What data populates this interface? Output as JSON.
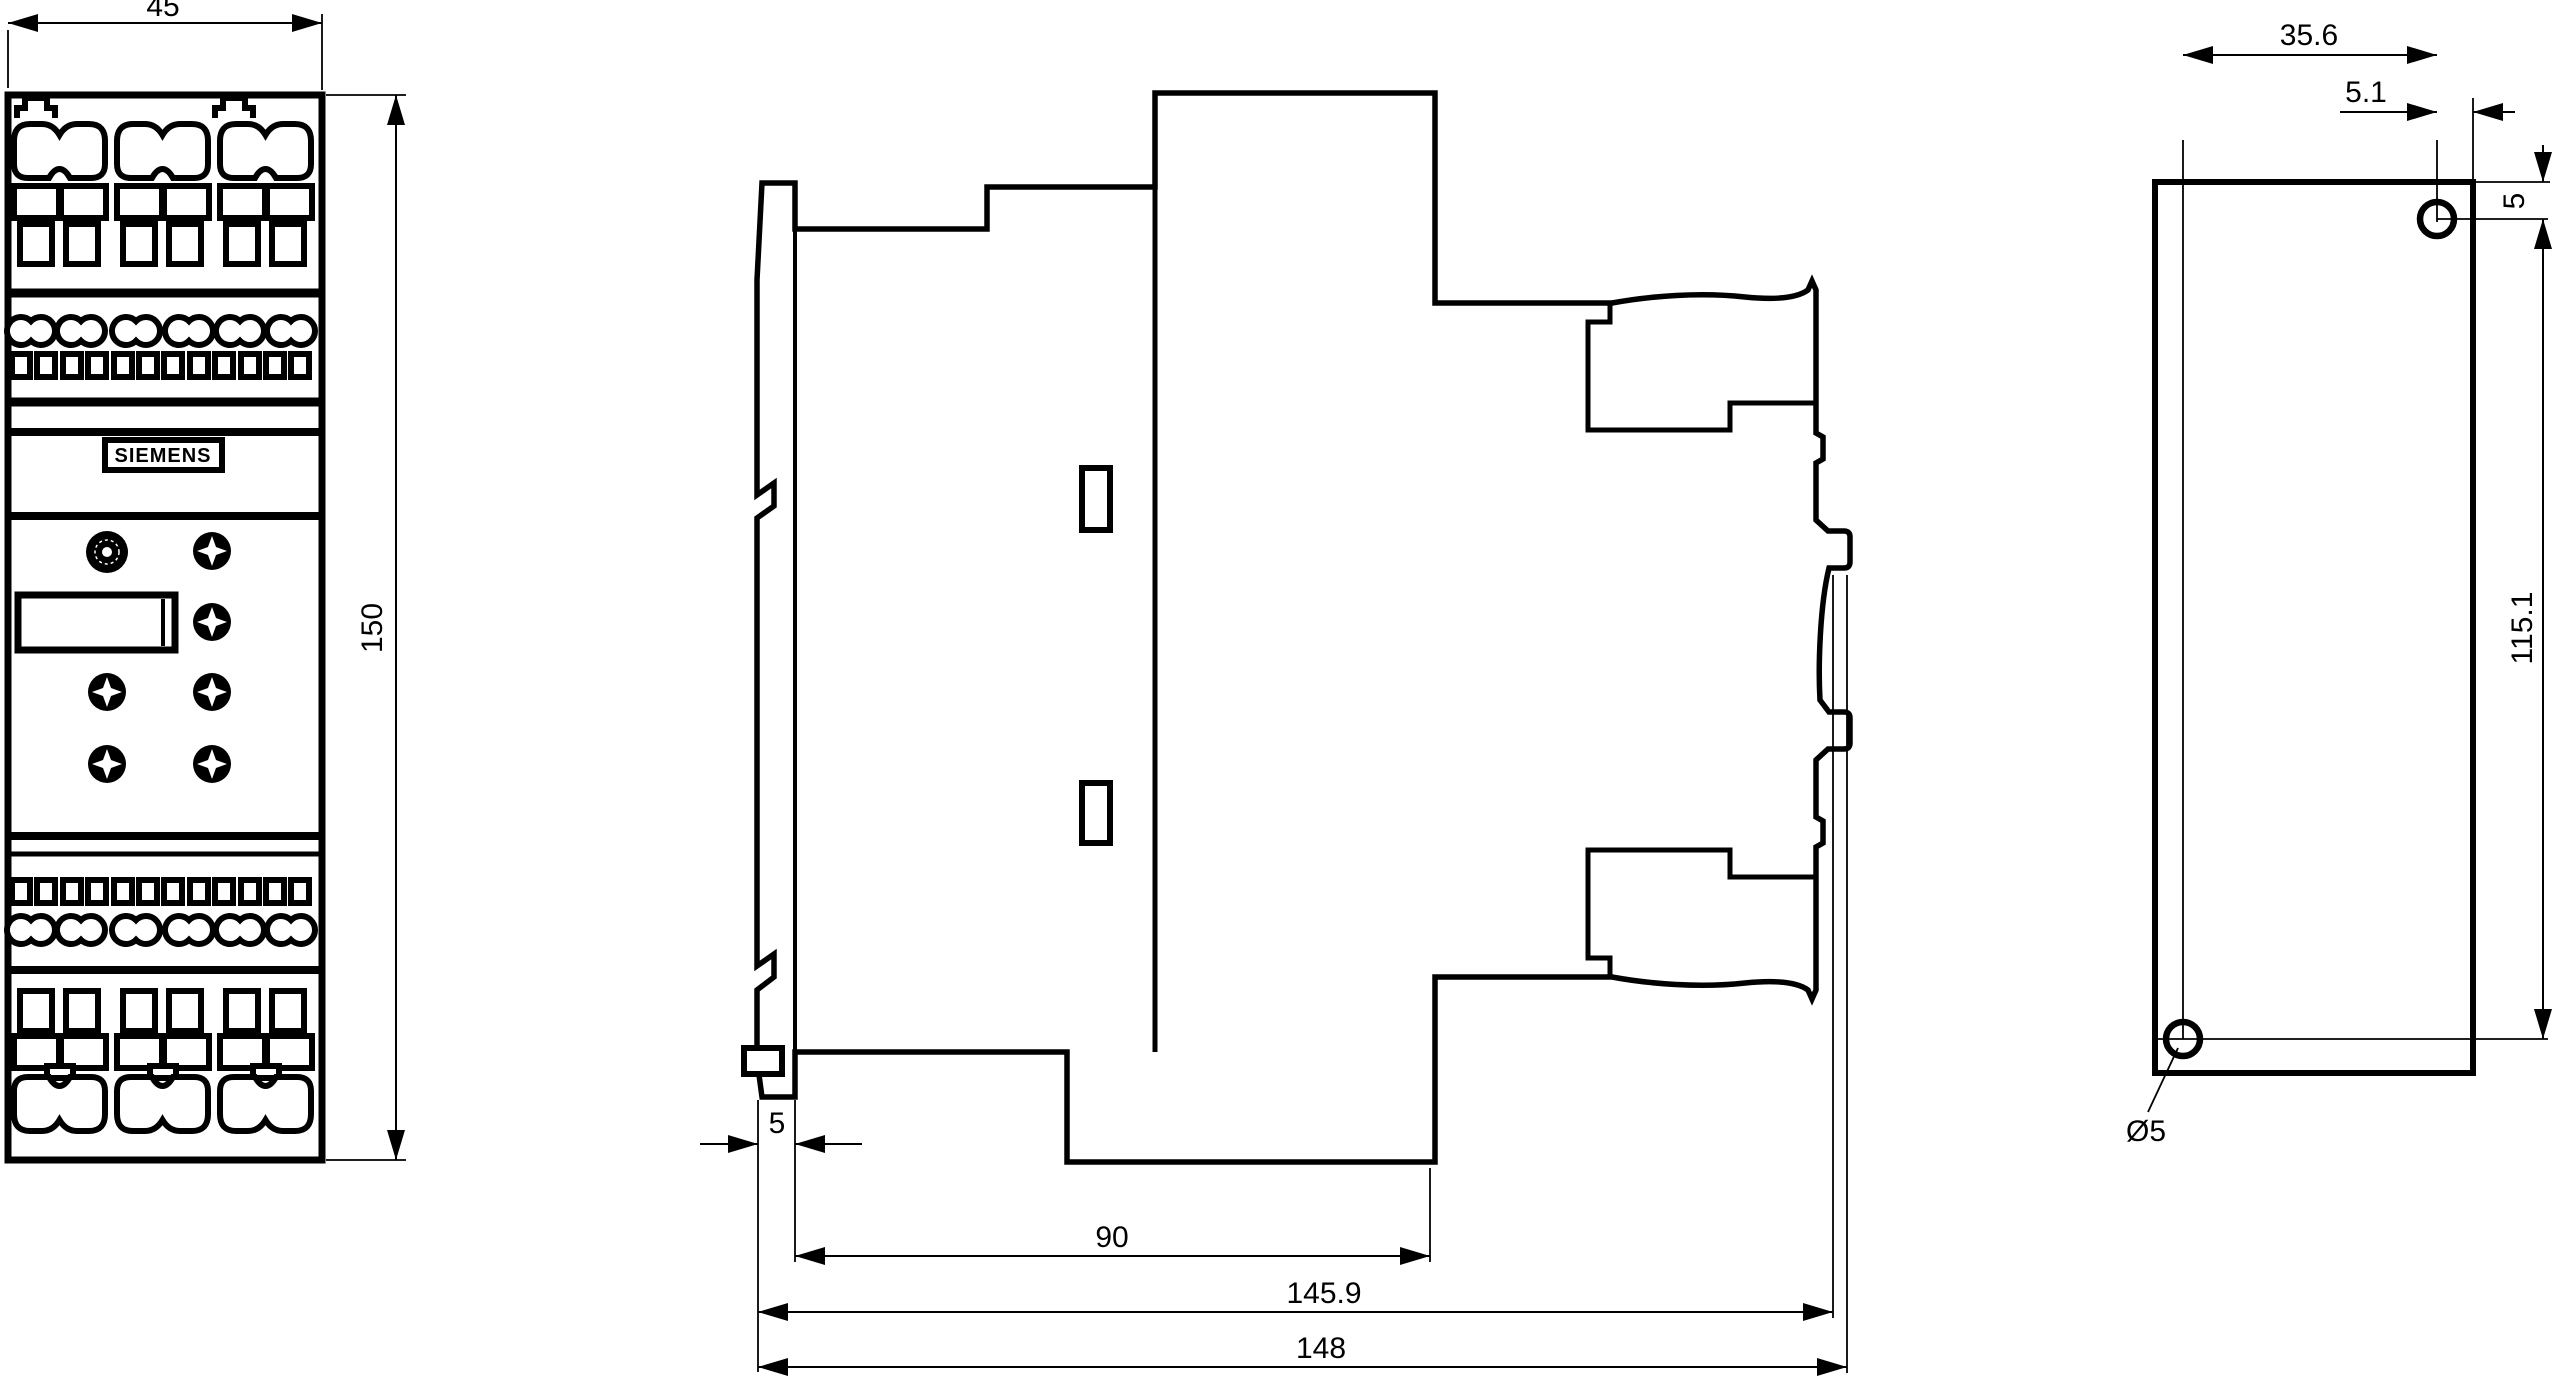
{
  "drawing_type": "technical-dimension-drawing",
  "device": "DIN-rail mounted control device (3 views)",
  "colors": {
    "line_color": "#000000",
    "background_color": "#ffffff"
  },
  "front_view": {
    "width_label": "45",
    "height_label": "150",
    "brand": "SIEMENS"
  },
  "side_view": {
    "clip_width_label": "5",
    "body_depth_label": "90",
    "depth_minor_label": "145.9",
    "depth_total_label": "148"
  },
  "rear_view": {
    "hole_offset_horizontal_label": "35.6",
    "hole_edge_offset_label": "5.1",
    "hole_top_offset_label": "5",
    "hole_spacing_label": "115.1",
    "hole_diameter_label": "Ø5"
  }
}
